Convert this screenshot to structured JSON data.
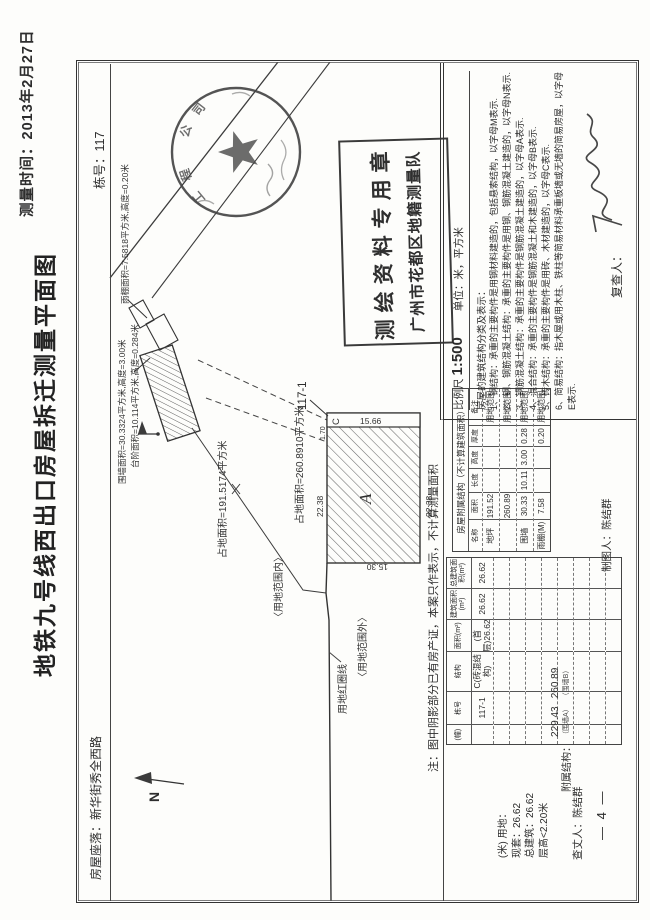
{
  "page": {
    "survey_time": "测量时间：2013年2月27日",
    "title": "地铁九号线西出口房屋拆迁测量平面图",
    "building_no": "栋号：117",
    "address": "房屋座落：新华街秀全西路",
    "page_number": "— 4 —"
  },
  "map": {
    "north_label": "N",
    "canopy_label": "雨棚面积=7.5818平方米,高度=0.20米",
    "wall_label": "围墙面积=30.3324平方米,高度=3.00米",
    "steps_label": "台阶面积=10.114平方米,高度=0.284米",
    "plot_area_1": "占地面积=191.5174平方米",
    "plot_area_2": "占地面积=260.8910平方米",
    "red_line_label": "用地红圈线",
    "inside_label": "〈用地范围内〉",
    "outside_label": "〈用地范围外〉",
    "parcel_label": "117-1",
    "letter_a": "A",
    "letter_c": "C",
    "dim_top": "22.38",
    "dim_bottom": "22.38",
    "dim_left": "15.30",
    "dim_strip": "15.66",
    "dim_small": "1.70"
  },
  "seals": {
    "circle_arc": [
      "工",
      "程",
      "公",
      "司"
    ],
    "rect_line1": "测绘资料专用章",
    "rect_line2": "广州市花都区地籍测量队"
  },
  "note": "注：图中阴影部分已有房产证，本案只作表示，不计算测量面积",
  "summary": {
    "line1": "(米) 用地：",
    "line2": "现套：26.62",
    "line3": "总建筑：26.62",
    "line4": "层高<2.20米"
  },
  "attachments": {
    "label": "附属结构：",
    "items": [
      {
        "value": "229.43",
        "note": "（围墙A）"
      },
      {
        "value": "260.89",
        "note": "（围墙B）"
      }
    ]
  },
  "people": {
    "surveyor": "查丈人：陈结群",
    "drafter": "制图人：陈结群",
    "reviewer": "复查人："
  },
  "main_table": {
    "headers": [
      "(幢)",
      "栋号",
      "结构",
      "面积(m²)",
      "建筑面积(m²)",
      "总建筑面积(m²)"
    ],
    "row": [
      "",
      "117-1",
      "C(砖混结构)",
      "(首层)26.62",
      "26.62",
      "26.62"
    ],
    "empty_rows": 8
  },
  "aux_table": {
    "title": "房屋附属结构（不计算建筑面积）",
    "headers": [
      "名称",
      "面积",
      "长度",
      "高度",
      "厚度",
      "备注"
    ],
    "rows": [
      [
        "地坪",
        "191.52",
        "",
        "",
        "",
        "用地范围"
      ],
      [
        "",
        "260.89",
        "",
        "",
        "",
        "用地范围"
      ],
      [
        "围墙",
        "30.33",
        "10.11",
        "3.00",
        "0.28",
        "用地范围"
      ],
      [
        "雨棚(M)",
        "7.58",
        "",
        "",
        "0.20",
        "用地范围"
      ]
    ]
  },
  "legend": {
    "scale_label": "比例尺",
    "scale_value": "1:500",
    "unit_label": "单位：米，平方米",
    "intro": "房屋的建筑结构分类及表示：",
    "notes": [
      "1、钢结构：承重的主要构件是用钢材料建造的，包括悬索结构，以字母M表示.",
      "2、钢、钢筋混凝土结构：承重的主要构件是用钢、钢筋混凝土建造的，以字母N表示.",
      "3、钢筋混凝土结构：承重的主要构件是钢筋混凝土建造的，以字母A表示.",
      "4、混合结构：承重的主要构件是钢筋混凝土和木建造的，以字母B表示.",
      "5、砖木结构：承重的主要构件是用砖、木材建造的，以字母C表示.",
      "6、简易结构：指木屋或用木柱、铁柱等简易材料承重板墙或无墙的简易房屋，以字母E表示."
    ]
  }
}
